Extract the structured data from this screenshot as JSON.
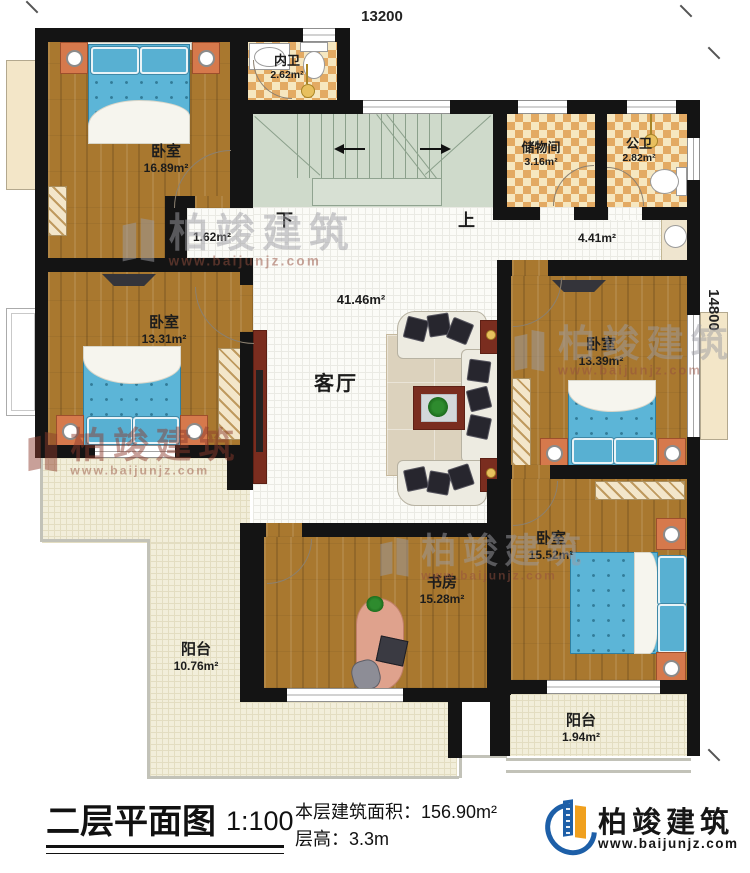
{
  "plan": {
    "dim_top": "13200",
    "dim_right": "14800",
    "stairs": {
      "down_label": "下",
      "up_label": "上"
    },
    "rooms": [
      {
        "name": "卧室",
        "area": "16.89m²"
      },
      {
        "name": "内卫",
        "area": "2.62m²"
      },
      {
        "name": "储物间",
        "area": "3.16m²"
      },
      {
        "name": "公卫",
        "area": "2.82m²"
      },
      {
        "name": "",
        "area": "1.62m²"
      },
      {
        "name": "",
        "area": "4.41m²"
      },
      {
        "name": "客厅",
        "area": "41.46m²"
      },
      {
        "name": "卧室",
        "area": "13.31m²"
      },
      {
        "name": "卧室",
        "area": "13.39m²"
      },
      {
        "name": "卧室",
        "area": "15.52m²"
      },
      {
        "name": "书房",
        "area": "15.28m²"
      },
      {
        "name": "阳台",
        "area": "10.76m²"
      },
      {
        "name": "阳台",
        "area": "1.94m²"
      }
    ]
  },
  "watermark": {
    "brand": "柏竣建筑",
    "url": "www.baijunjz.com"
  },
  "title_block": {
    "title": "二层平面图",
    "scale": "1:100",
    "floor_area": "本层建筑面积：156.90m²",
    "floor_height": "层高：3.3m",
    "brand": "柏竣建筑",
    "website": "www.baijunjz.com"
  },
  "colors": {
    "wall": "#141414",
    "wood_floor": "#a9782f",
    "bed_blue": "#5cb5d7",
    "brand_blue": "#1d5fa8",
    "brand_orange": "#f0a01e"
  }
}
